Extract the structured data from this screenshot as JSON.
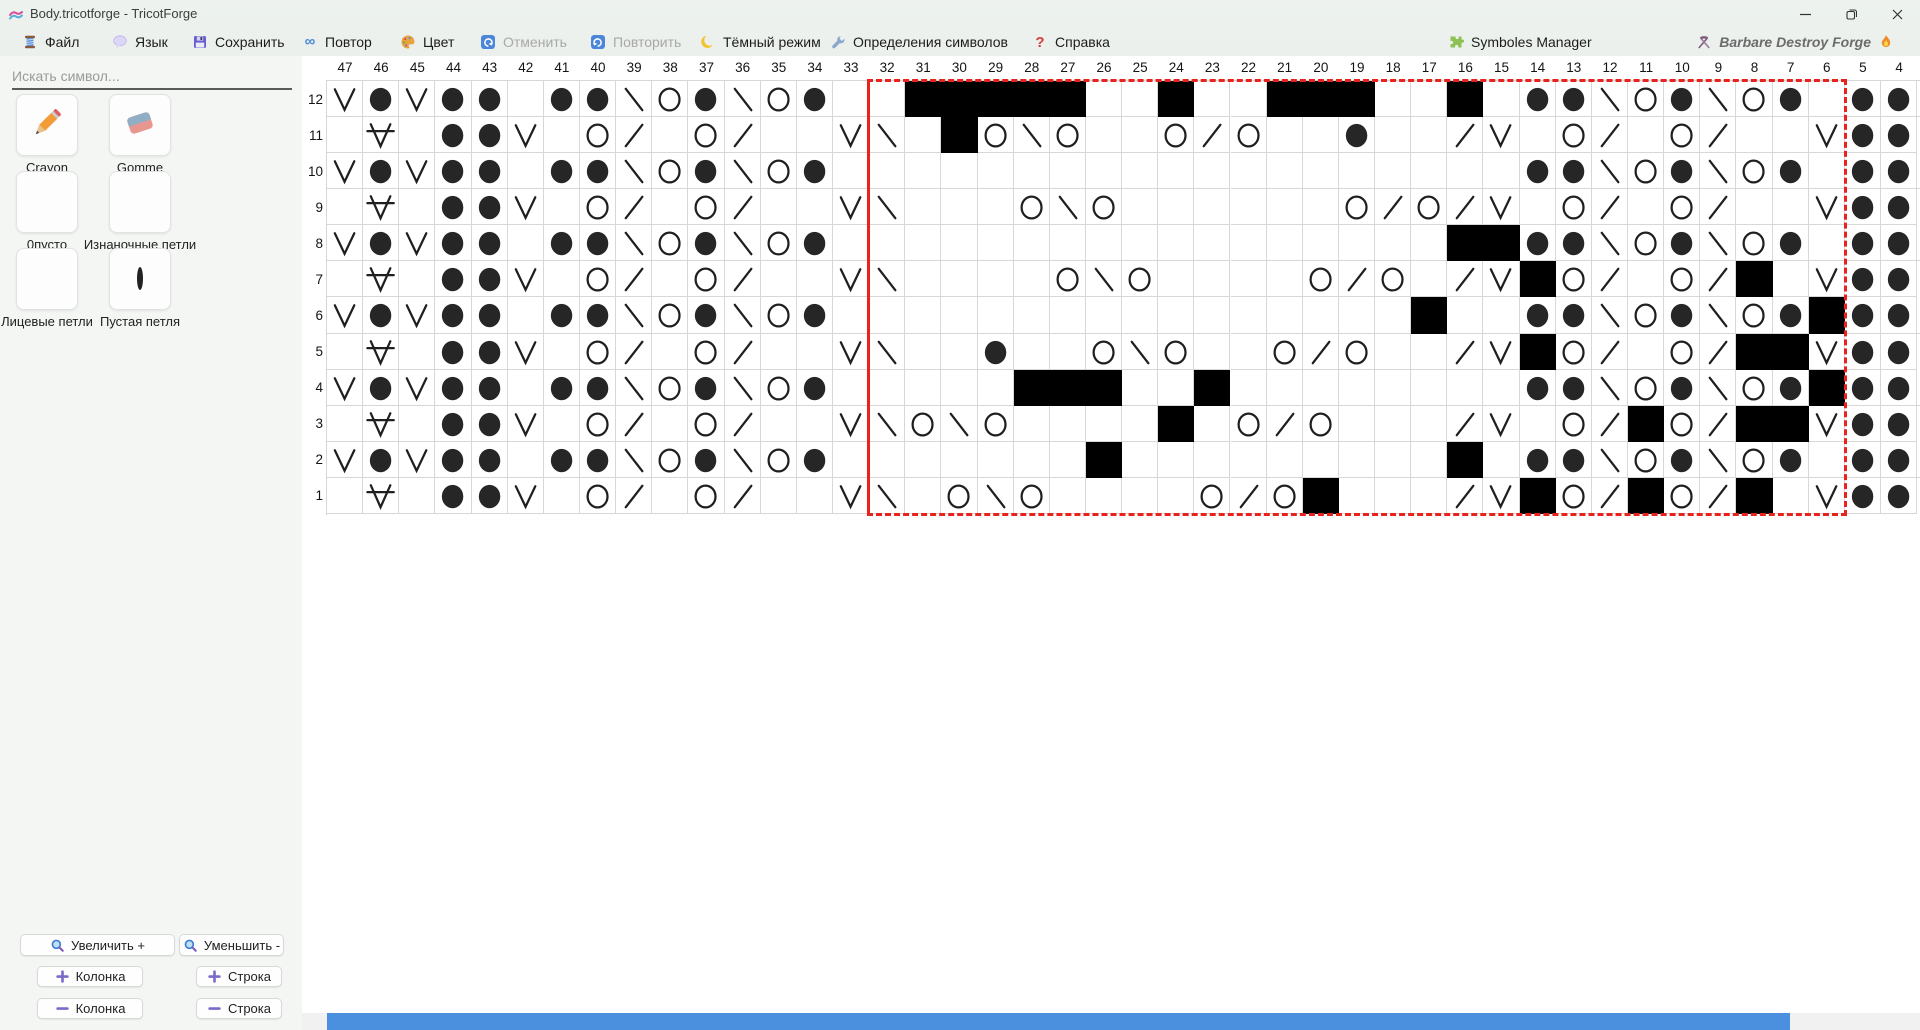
{
  "window": {
    "title": "Body.tricotforge - TricotForge",
    "controls": {
      "minimize": "minimize",
      "maximize": "maximize",
      "close": "close"
    }
  },
  "menubar": {
    "items": [
      {
        "id": "file",
        "label": "Файл",
        "icon": "spool-icon",
        "disabled": false
      },
      {
        "id": "language",
        "label": "Язык",
        "icon": "speech-icon",
        "disabled": false
      },
      {
        "id": "save",
        "label": "Сохранить",
        "icon": "floppy-icon",
        "disabled": false
      },
      {
        "id": "repeat",
        "label": "Повтор",
        "icon": "infinity-icon",
        "disabled": false
      },
      {
        "id": "color",
        "label": "Цвет",
        "icon": "palette-icon",
        "disabled": false
      },
      {
        "id": "undo",
        "label": "Отменить",
        "icon": "undo-icon",
        "disabled": true
      },
      {
        "id": "redo",
        "label": "Повторить",
        "icon": "redo-icon",
        "disabled": true
      },
      {
        "id": "dark-mode",
        "label": "Тёмный режим",
        "icon": "moon-icon",
        "disabled": false
      },
      {
        "id": "symbol-definitions",
        "label": "Определения символов",
        "icon": "wrench-icon",
        "disabled": false
      },
      {
        "id": "help",
        "label": "Справка",
        "icon": "question-icon",
        "disabled": false
      }
    ],
    "symbols_manager": {
      "label": "Symboles Manager",
      "icon": "puzzle-icon"
    },
    "brand": {
      "label": "Barbare Destroy Forge",
      "icon_left": "hammer-pick-icon",
      "icon_right": "flame-icon"
    }
  },
  "sidebar": {
    "search": {
      "placeholder": "Искать символ..."
    },
    "tools": [
      {
        "id": "crayon",
        "label": "Crayon",
        "icon": "pencil-icon"
      },
      {
        "id": "gomme",
        "label": "Gomme",
        "icon": "eraser-icon"
      },
      {
        "id": "empty",
        "label": "0пусто",
        "icon": "blank-icon"
      },
      {
        "id": "purl",
        "label": "Изнаночные петли",
        "icon": "hline-icon"
      },
      {
        "id": "knit",
        "label": "Лицевые петли",
        "icon": "vline-icon"
      },
      {
        "id": "empty-loop",
        "label": "Пустая петля",
        "icon": "circle-icon"
      }
    ],
    "actions": [
      {
        "id": "zoom-in",
        "label": "Увеличить +",
        "icon": "magnifier-icon"
      },
      {
        "id": "zoom-out",
        "label": "Уменьшить -",
        "icon": "magnifier-icon"
      },
      {
        "id": "add-column",
        "label": "Колонка",
        "icon": "plus-icon"
      },
      {
        "id": "add-row",
        "label": "Строка",
        "icon": "plus-icon"
      },
      {
        "id": "remove-column",
        "label": "Колонка",
        "icon": "minus-icon"
      },
      {
        "id": "remove-row",
        "label": "Строка",
        "icon": "minus-icon"
      }
    ]
  },
  "chart_data": {
    "type": "knitting-chart-grid",
    "columns": [
      47,
      46,
      45,
      44,
      43,
      42,
      41,
      40,
      39,
      38,
      37,
      36,
      35,
      34,
      33,
      32,
      31,
      30,
      29,
      28,
      27,
      26,
      25,
      24,
      23,
      22,
      21,
      20,
      19,
      18,
      17,
      16,
      15,
      14,
      13,
      12,
      11,
      10,
      9,
      8,
      7,
      6,
      5,
      4
    ],
    "rows": [
      12,
      11,
      10,
      9,
      8,
      7,
      6,
      5,
      4,
      3,
      2,
      1
    ],
    "partial_column": {
      "number": 3,
      "even_row_symbol": "V"
    },
    "repeat_region": {
      "from_column": 32,
      "to_column": 6,
      "row_top": 12,
      "row_bottom": 1,
      "border_color": "#e8231d"
    },
    "symbol_legend": {
      "V": "v-stitch",
      "A": "v-with-bar-stitch",
      "D": "filled-dot-stitch",
      "O": "open-circle-stitch",
      "B": "backslash-decrease",
      "F": "slash-decrease",
      "S": "black-square",
      ".": "empty"
    },
    "cells": {
      "12": [
        "V",
        "D",
        "V",
        "D",
        "D",
        ".",
        "D",
        "D",
        "B",
        "O",
        "D",
        "B",
        "O",
        "D",
        ".",
        ".",
        "S",
        "S",
        "S",
        "S",
        "S",
        ".",
        ".",
        "S",
        ".",
        ".",
        "S",
        "S",
        "S",
        ".",
        ".",
        "S",
        ".",
        "D",
        "D",
        "B",
        "O",
        "D",
        "B",
        "O",
        "D",
        ".",
        "D",
        "D"
      ],
      "11": [
        ".",
        "A",
        ".",
        "D",
        "D",
        "V",
        ".",
        "O",
        "F",
        ".",
        "O",
        "F",
        ".",
        ".",
        "V",
        "B",
        ".",
        "S",
        "O",
        "B",
        "O",
        ".",
        ".",
        "O",
        "F",
        "O",
        ".",
        ".",
        "D",
        ".",
        ".",
        "F",
        "V",
        ".",
        "O",
        "F",
        ".",
        "O",
        "F",
        ".",
        ".",
        "V",
        "D",
        "D"
      ],
      "10": [
        "V",
        "D",
        "V",
        "D",
        "D",
        ".",
        "D",
        "D",
        "B",
        "O",
        "D",
        "B",
        "O",
        "D",
        ".",
        ".",
        ".",
        ".",
        ".",
        ".",
        ".",
        ".",
        ".",
        ".",
        ".",
        ".",
        ".",
        ".",
        ".",
        ".",
        ".",
        ".",
        ".",
        "D",
        "D",
        "B",
        "O",
        "D",
        "B",
        "O",
        "D",
        ".",
        "D",
        "D"
      ],
      "9": [
        ".",
        "A",
        ".",
        "D",
        "D",
        "V",
        ".",
        "O",
        "F",
        ".",
        "O",
        "F",
        ".",
        ".",
        "V",
        "B",
        ".",
        ".",
        ".",
        "O",
        "B",
        "O",
        ".",
        ".",
        ".",
        ".",
        ".",
        ".",
        "O",
        "F",
        "O",
        "F",
        "V",
        ".",
        "O",
        "F",
        ".",
        "O",
        "F",
        ".",
        ".",
        "V",
        "D",
        "D"
      ],
      "8": [
        "V",
        "D",
        "V",
        "D",
        "D",
        ".",
        "D",
        "D",
        "B",
        "O",
        "D",
        "B",
        "O",
        "D",
        ".",
        ".",
        ".",
        ".",
        ".",
        ".",
        ".",
        ".",
        ".",
        ".",
        ".",
        ".",
        ".",
        ".",
        ".",
        ".",
        ".",
        "S",
        "S",
        "D",
        "D",
        "B",
        "O",
        "D",
        "B",
        "O",
        "D",
        ".",
        "D",
        "D"
      ],
      "7": [
        ".",
        "A",
        ".",
        "D",
        "D",
        "V",
        ".",
        "O",
        "F",
        ".",
        "O",
        "F",
        ".",
        ".",
        "V",
        "B",
        ".",
        ".",
        ".",
        ".",
        "O",
        "B",
        "O",
        ".",
        ".",
        ".",
        ".",
        "O",
        "F",
        "O",
        ".",
        "F",
        "V",
        "S",
        "O",
        "F",
        ".",
        "O",
        "F",
        "S",
        ".",
        "V",
        "D",
        "D"
      ],
      "6": [
        "V",
        "D",
        "V",
        "D",
        "D",
        ".",
        "D",
        "D",
        "B",
        "O",
        "D",
        "B",
        "O",
        "D",
        ".",
        ".",
        ".",
        ".",
        ".",
        ".",
        ".",
        ".",
        ".",
        ".",
        ".",
        ".",
        ".",
        ".",
        ".",
        ".",
        "S",
        ".",
        ".",
        "D",
        "D",
        "B",
        "O",
        "D",
        "B",
        "O",
        "D",
        "S",
        "D",
        "D"
      ],
      "5": [
        ".",
        "A",
        ".",
        "D",
        "D",
        "V",
        ".",
        "O",
        "F",
        ".",
        "O",
        "F",
        ".",
        ".",
        "V",
        "B",
        ".",
        ".",
        "D",
        ".",
        ".",
        "O",
        "B",
        "O",
        ".",
        ".",
        "O",
        "F",
        "O",
        ".",
        ".",
        "F",
        "V",
        "S",
        "O",
        "F",
        ".",
        "O",
        "F",
        "S",
        "S",
        "V",
        "D",
        "D"
      ],
      "4": [
        "V",
        "D",
        "V",
        "D",
        "D",
        ".",
        "D",
        "D",
        "B",
        "O",
        "D",
        "B",
        "O",
        "D",
        ".",
        ".",
        ".",
        ".",
        ".",
        "S",
        "S",
        "S",
        ".",
        ".",
        "S",
        ".",
        ".",
        ".",
        ".",
        ".",
        ".",
        ".",
        ".",
        "D",
        "D",
        "B",
        "O",
        "D",
        "B",
        "O",
        "D",
        "S",
        "D",
        "D"
      ],
      "3": [
        ".",
        "A",
        ".",
        "D",
        "D",
        "V",
        ".",
        "O",
        "F",
        ".",
        "O",
        "F",
        ".",
        ".",
        "V",
        "B",
        "O",
        "B",
        "O",
        ".",
        ".",
        ".",
        ".",
        "S",
        ".",
        "O",
        "F",
        "O",
        ".",
        ".",
        ".",
        "F",
        "V",
        ".",
        "O",
        "F",
        "S",
        "O",
        "F",
        "S",
        "S",
        "V",
        "D",
        "D"
      ],
      "2": [
        "V",
        "D",
        "V",
        "D",
        "D",
        ".",
        "D",
        "D",
        "B",
        "O",
        "D",
        "B",
        "O",
        "D",
        ".",
        ".",
        ".",
        ".",
        ".",
        ".",
        ".",
        "S",
        ".",
        ".",
        ".",
        ".",
        ".",
        ".",
        ".",
        ".",
        ".",
        "S",
        ".",
        "D",
        "D",
        "B",
        "O",
        "D",
        "B",
        "O",
        "D",
        ".",
        "D",
        "D"
      ],
      "1": [
        ".",
        "A",
        ".",
        "D",
        "D",
        "V",
        ".",
        "O",
        "F",
        ".",
        "O",
        "F",
        ".",
        ".",
        "V",
        "B",
        ".",
        "O",
        "B",
        "O",
        ".",
        ".",
        ".",
        ".",
        "O",
        "F",
        "O",
        "S",
        ".",
        ".",
        ".",
        "F",
        "V",
        "S",
        "O",
        "F",
        "S",
        "O",
        "F",
        "S",
        ".",
        "V",
        "D",
        "D"
      ]
    }
  },
  "scrollbar": {
    "orientation": "horizontal",
    "thumb_color": "#4b8fdf"
  },
  "colors": {
    "repeat_red": "#e8231d",
    "symbol_ink": "#1f1f1f",
    "accent_blue": "#4b8fdf"
  }
}
